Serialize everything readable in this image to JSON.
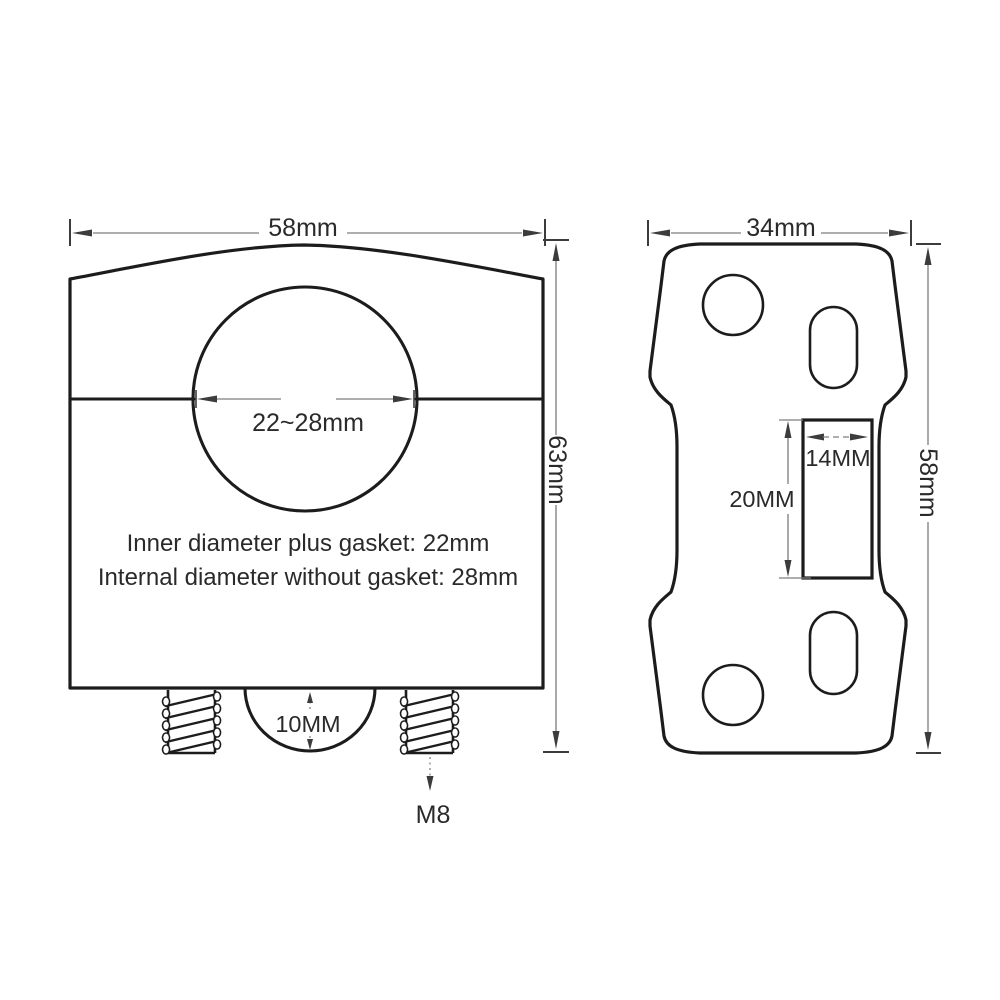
{
  "front_view": {
    "width_dim": "58mm",
    "height_dim": "63mm",
    "bore_dim": "22~28mm",
    "note_line1": "Inner diameter plus gasket: 22mm",
    "note_line2": "Internal diameter without gasket: 28mm",
    "boss_dim": "10MM",
    "thread_label": "M8"
  },
  "top_view": {
    "width_dim": "34mm",
    "height_dim": "58mm",
    "slot_width_dim": "14MM",
    "slot_length_dim": "20MM"
  },
  "colors": {
    "outline": "#1c1c1c",
    "dim_line": "#7d7d7d",
    "dim_mark": "#3c3c3c",
    "label": "#2a2a2a",
    "background": "#ffffff"
  }
}
